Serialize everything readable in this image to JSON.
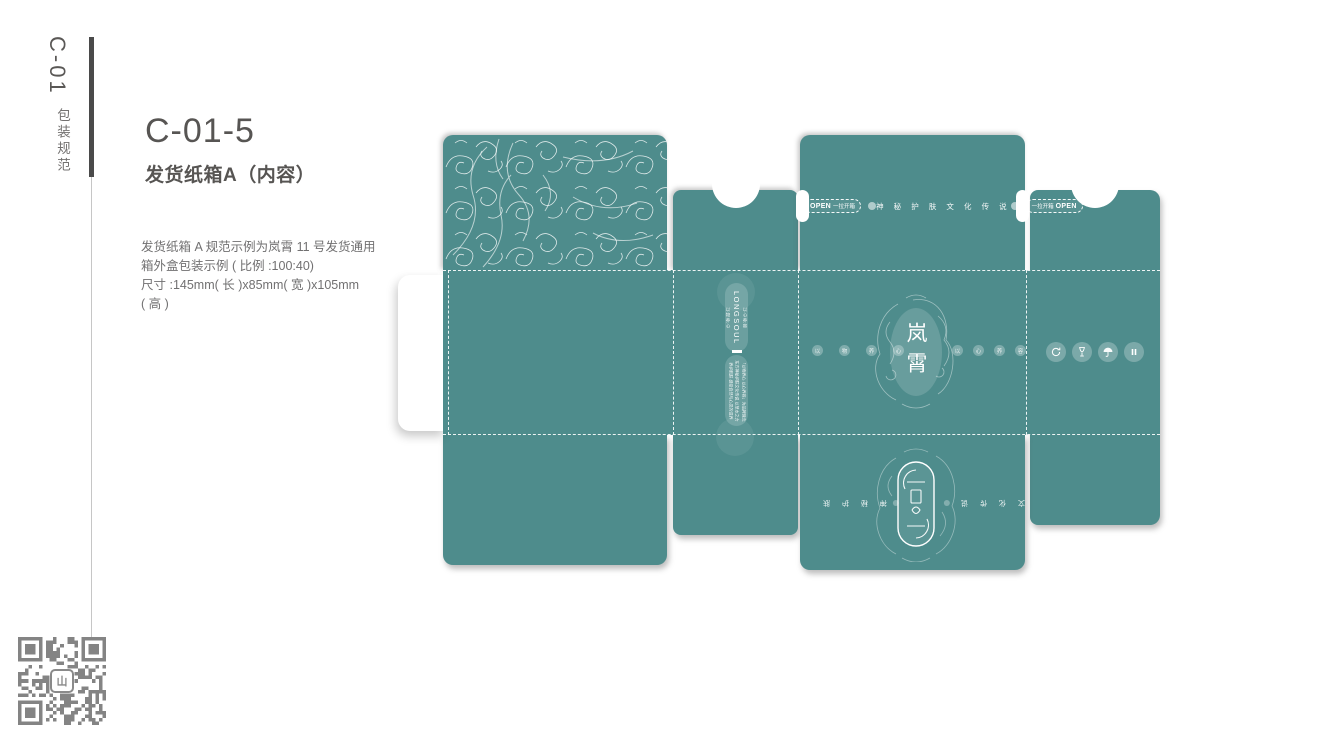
{
  "sidebar": {
    "code": "C-01",
    "label": "包装规范"
  },
  "header": {
    "title": "C-01-5",
    "subtitle": "发货纸箱A（内容）"
  },
  "description": {
    "line1": "发货纸箱 A 规范示例为岚霄 11 号发货通用",
    "line2": "箱外盒包装示例 ( 比例 :100:40)",
    "line3": "尺寸 :145mm( 长 )x85mm( 宽 )x105mm",
    "line4": "( 高 )"
  },
  "dieline": {
    "teal": "#4e8c8c",
    "open_strip": {
      "left_open": "OPEN",
      "left_cn": "一拉开箱",
      "right_cn": "一拉开箱",
      "right_open": "OPEN",
      "text": "神 秘 护 肤 文 化 传 说"
    },
    "brand_capsule": {
      "side_left": "以物养心",
      "brand": "LONGSOUL",
      "side_right": "以心养容",
      "para1": "「以物养心 以心养容」为品牌理念",
      "para2": "东方神秘护肤文化传说 以草本之力",
      "para3": "养护肌肤 感受自然与心灵的滋养"
    },
    "center_emblem": {
      "chars": "岚霄",
      "left_dots": [
        "以",
        "物",
        "养",
        "心"
      ],
      "right_dots": [
        "以",
        "心",
        "养",
        "容"
      ]
    },
    "care_icons": [
      "recycle",
      "fragile-glass",
      "keep-dry-umbrella",
      "handle-with-care"
    ],
    "bottom_emblem": {
      "left_text": "神 秘 护 肤",
      "right_text": "文 化 传 说"
    }
  },
  "qr": {
    "logo_glyph": "山"
  }
}
